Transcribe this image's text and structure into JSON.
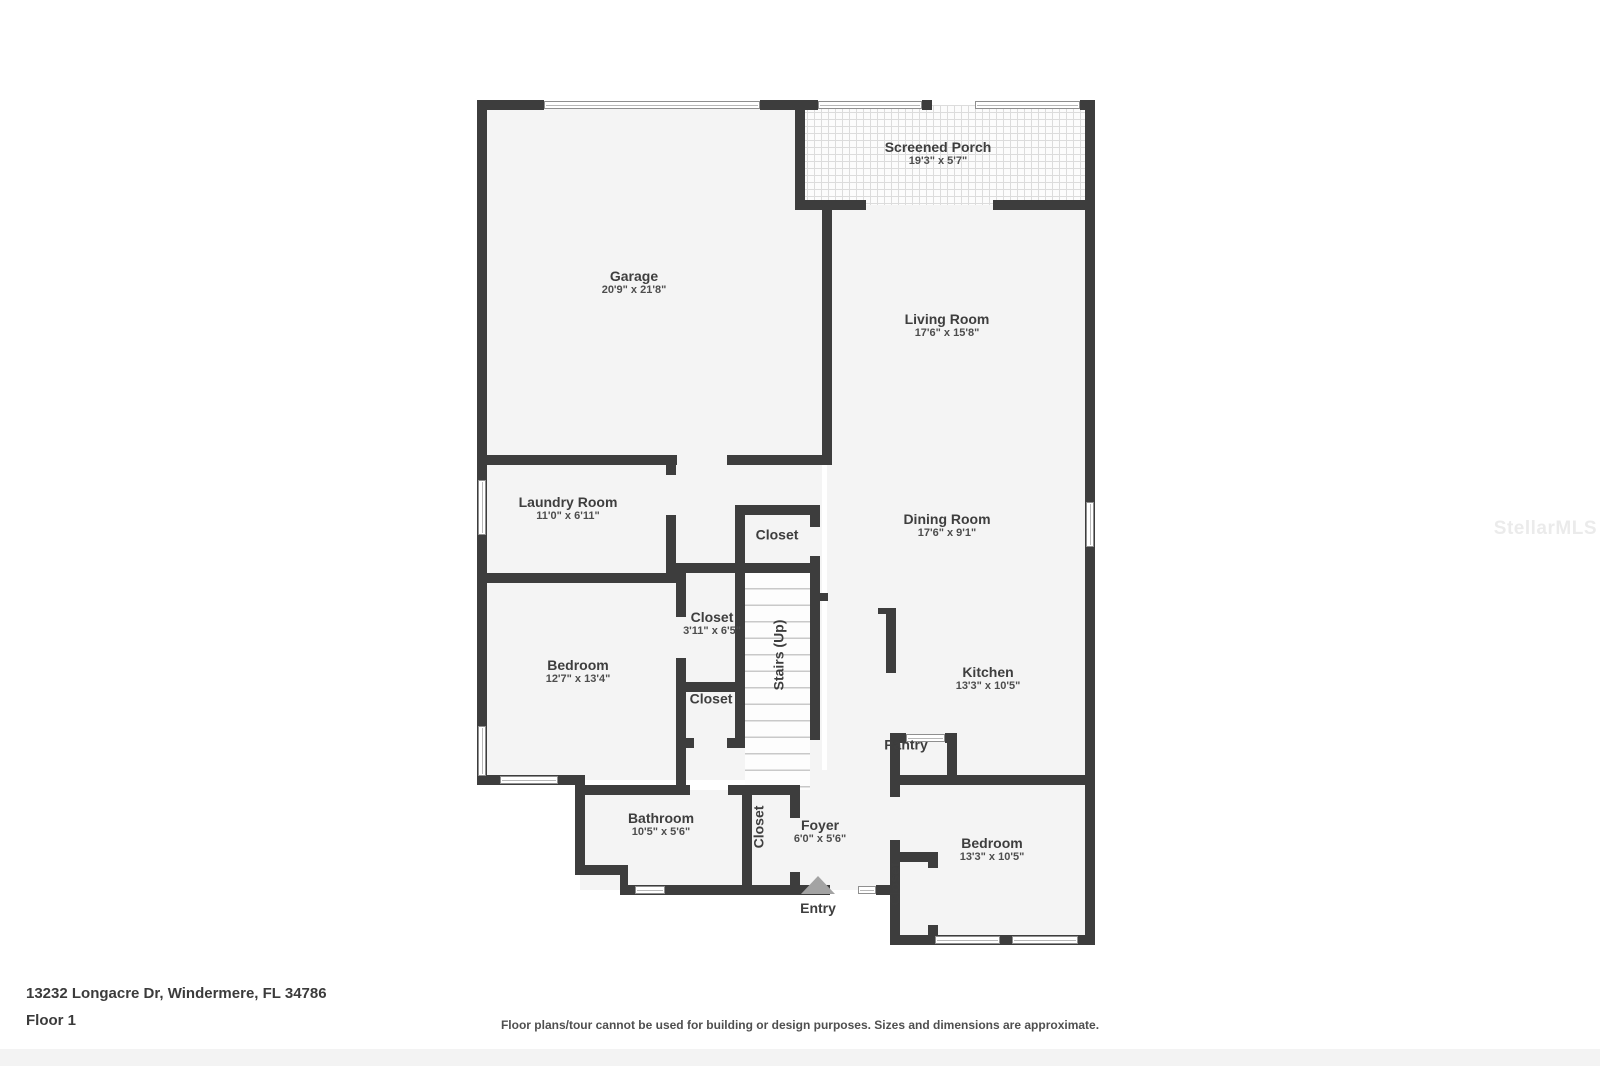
{
  "plan": {
    "rooms": [
      {
        "name": "Screened Porch",
        "dims": "19'3\" x 5'7\""
      },
      {
        "name": "Garage",
        "dims": "20'9\" x 21'8\""
      },
      {
        "name": "Living Room",
        "dims": "17'6\" x 15'8\""
      },
      {
        "name": "Laundry Room",
        "dims": "11'0\" x 6'11\""
      },
      {
        "name": "Closet",
        "dims": ""
      },
      {
        "name": "Dining Room",
        "dims": "17'6\" x 9'1\""
      },
      {
        "name": "Closet",
        "dims": "3'11\" x 6'5\""
      },
      {
        "name": "Stairs (Up)",
        "dims": ""
      },
      {
        "name": "Bedroom",
        "dims": "12'7\" x 13'4\""
      },
      {
        "name": "Kitchen",
        "dims": "13'3\" x 10'5\""
      },
      {
        "name": "Closet",
        "dims": ""
      },
      {
        "name": "Pantry",
        "dims": ""
      },
      {
        "name": "Bathroom",
        "dims": "10'5\" x 5'6\""
      },
      {
        "name": "Closet",
        "dims": ""
      },
      {
        "name": "Foyer",
        "dims": "6'0\" x 5'6\""
      },
      {
        "name": "Closet",
        "dims": ""
      },
      {
        "name": "Bedroom",
        "dims": "13'3\" x 10'5\""
      }
    ],
    "entry_label": "Entry"
  },
  "footer": {
    "address": "13232 Longacre Dr, Windermere, FL 34786",
    "floor_label": "Floor 1",
    "disclaimer": "Floor plans/tour cannot be used for building or design purposes. Sizes and dimensions are approximate."
  },
  "watermark": "StellarMLS",
  "colors": {
    "wall": "#3d3d3d",
    "floor_fill": "#f4f4f4",
    "label_text": "#3e3e3e",
    "entry_arrow": "#a3a3a3"
  }
}
